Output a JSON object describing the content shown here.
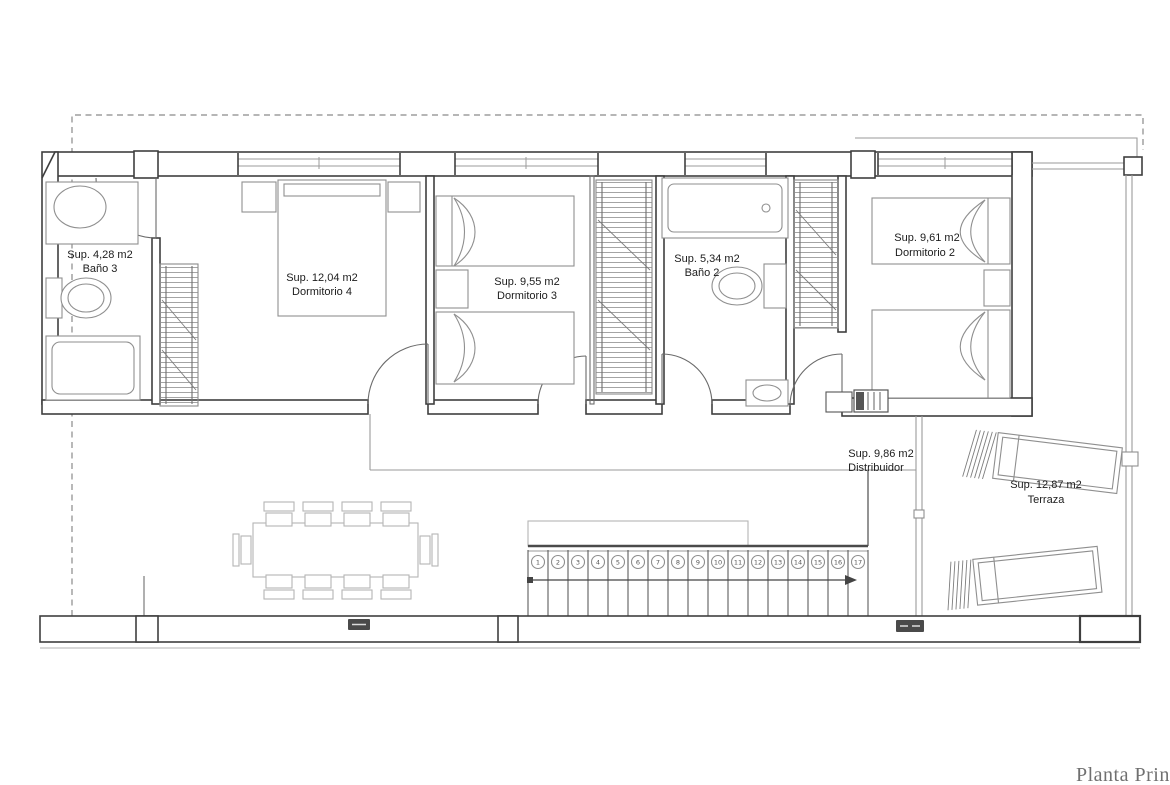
{
  "plan_title": "Planta Prin",
  "colors": {
    "wall_ink": "#3f3f3f",
    "furniture_ink": "#8f8f8f",
    "lower_floor_ink": "#b5b5b5",
    "label_ink": "#1c1c1c",
    "title_ink": "#707070",
    "background": "#ffffff"
  },
  "rooms": {
    "bano3": {
      "area": "Sup. 4,28 m2",
      "name": "Baño 3"
    },
    "dormitorio4": {
      "area": "Sup. 12,04 m2",
      "name": "Dormitorio 4"
    },
    "dormitorio3": {
      "area": "Sup. 9,55 m2",
      "name": "Dormitorio 3"
    },
    "bano2": {
      "area": "Sup. 5,34 m2",
      "name": "Baño 2"
    },
    "dormitorio2": {
      "area": "Sup. 9,61 m2",
      "name": "Dormitorio 2"
    },
    "distribuidor": {
      "area": "Sup. 9,86 m2",
      "name": "Distribuidor"
    },
    "terraza": {
      "area": "Sup. 12,87 m2",
      "name": "Terraza"
    }
  },
  "stairs": {
    "steps": [
      "1",
      "2",
      "3",
      "4",
      "5",
      "6",
      "7",
      "8",
      "9",
      "10",
      "11",
      "12",
      "13",
      "14",
      "15",
      "16",
      "17"
    ]
  }
}
